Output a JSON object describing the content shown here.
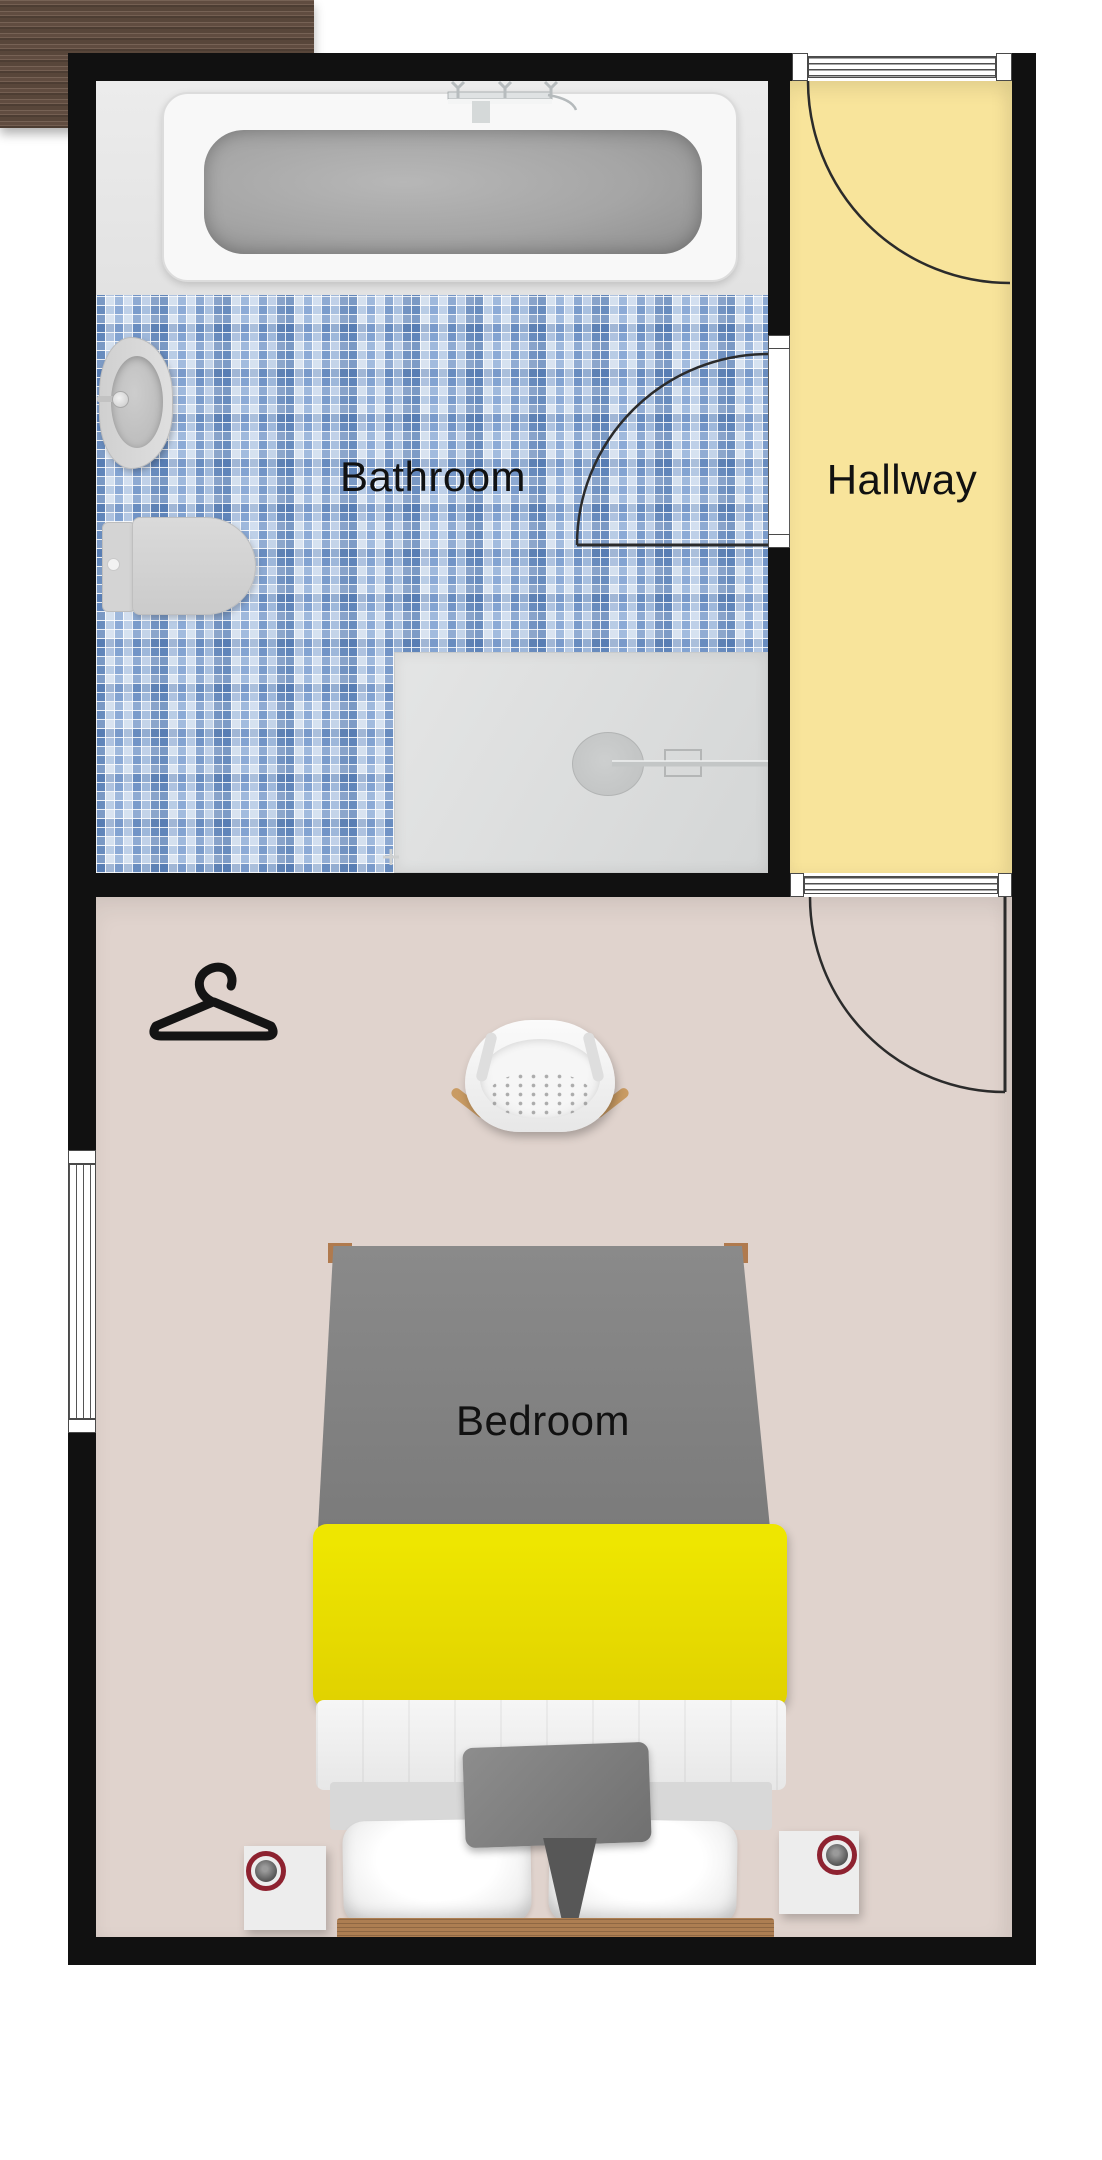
{
  "floorplan": {
    "rooms": {
      "bathroom": {
        "label": "Bathroom",
        "floor": "blue-mosaic-tile",
        "floor_base_color": "#b9cce4"
      },
      "hallway": {
        "label": "Hallway",
        "floor": "plain",
        "floor_color": "#f8e49b"
      },
      "bedroom": {
        "label": "Bedroom",
        "floor": "plain",
        "floor_color": "#e0d3cd"
      }
    },
    "walls": {
      "color": "#111111"
    },
    "doors": [
      {
        "name": "entry-door",
        "location": "hallway-top-wall",
        "type": "hinged-swing"
      },
      {
        "name": "bathroom-door",
        "location": "bathroom-hallway-wall",
        "type": "hinged-swing"
      },
      {
        "name": "bedroom-door",
        "location": "hallway-bedroom-wall",
        "type": "hinged-swing"
      }
    ],
    "windows": [
      {
        "name": "bedroom-window",
        "location": "bedroom-left-wall"
      }
    ],
    "fixtures": {
      "bathroom": [
        "bathtub",
        "bathtub-faucet",
        "pedestal-sink",
        "toilet",
        "shower",
        "shower-drain"
      ],
      "bedroom": [
        "dresser",
        "chair",
        "clothes-hanger",
        "double-bed",
        "nightstand-left",
        "nightstand-right",
        "table-lamp-left",
        "table-lamp-right"
      ]
    },
    "colors": {
      "bed_duvet_gray": "#838383",
      "bed_blanket_yellow": "#ebe104",
      "bed_frame_wood": "#ad7e52",
      "dresser_wood": "#6b5547",
      "lamp_ring_red": "#8e2230"
    }
  }
}
